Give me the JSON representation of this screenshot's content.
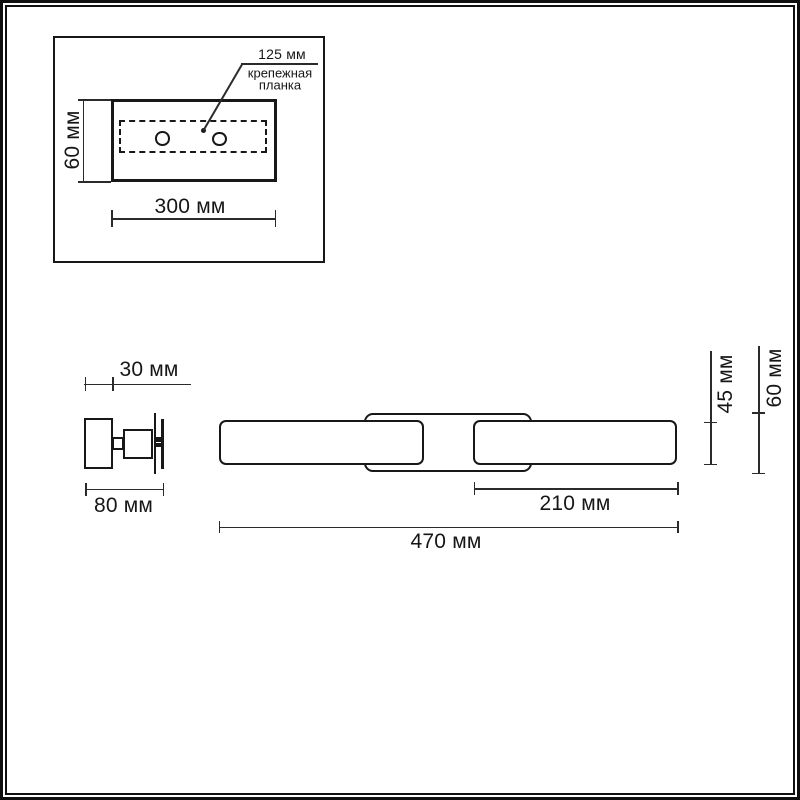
{
  "colors": {
    "background": "#ffffff",
    "shape_outline": "#181818",
    "dimension_line": "#2b2b2b",
    "text": "#161616"
  },
  "inset": {
    "hole_spacing": "125 мм",
    "callout_line1": "крепежная",
    "callout_line2": "планка",
    "height": "60 мм",
    "width": "300 мм"
  },
  "side_view": {
    "depth": "30 мм",
    "width": "80 мм"
  },
  "front_view": {
    "section": "210 мм",
    "total": "470 мм",
    "bar_height": "45 мм",
    "plate_height": "60 мм"
  }
}
